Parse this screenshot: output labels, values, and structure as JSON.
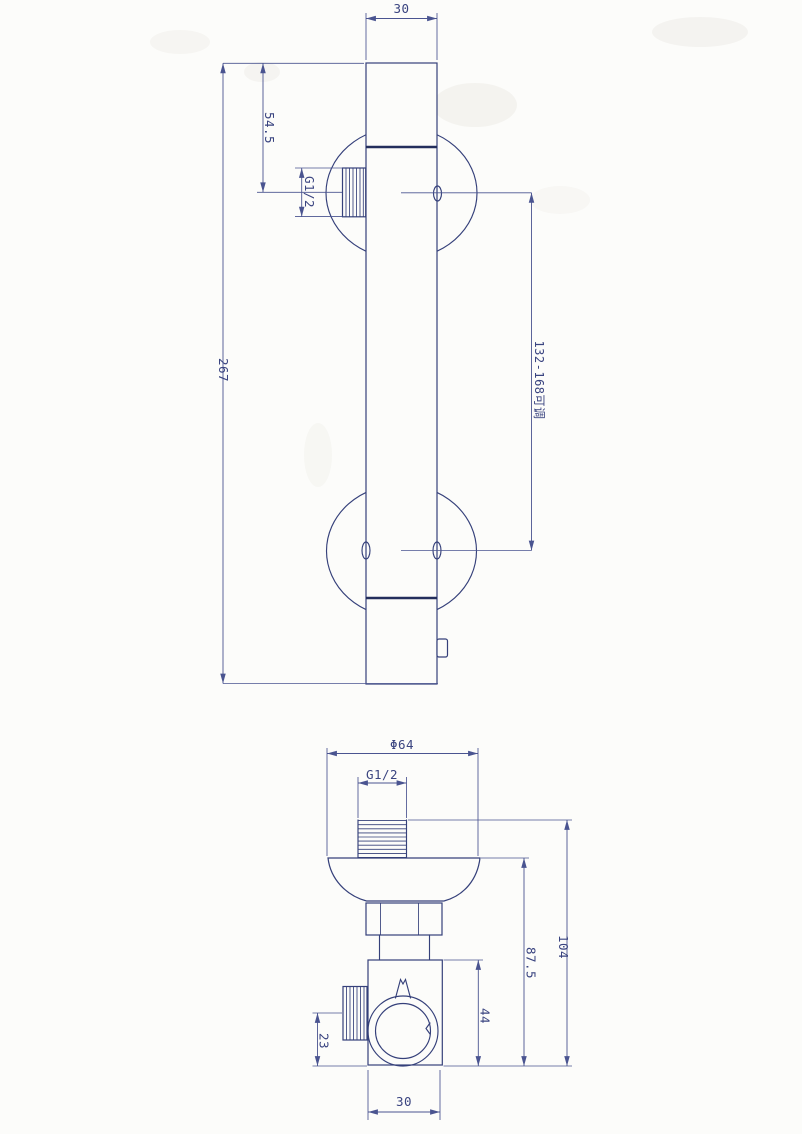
{
  "drawing": {
    "top_view": {
      "label_width": "30",
      "label_offset_top": "54.5",
      "label_total_height": "267",
      "label_thread": "G1/2",
      "label_adjust_range": "132-168可调"
    },
    "bottom_view": {
      "label_diameter": "Φ64",
      "label_thread": "G1/2",
      "label_height_total": "104",
      "label_height_body": "87.5",
      "label_height_block": "44",
      "label_offset_side": "23",
      "label_width_block": "30"
    },
    "colors": {
      "line": "#35407a",
      "dim_line": "#4a5490",
      "thick_line": "#232e5c",
      "text": "#3a4480",
      "background": "#fcfcfa"
    }
  }
}
